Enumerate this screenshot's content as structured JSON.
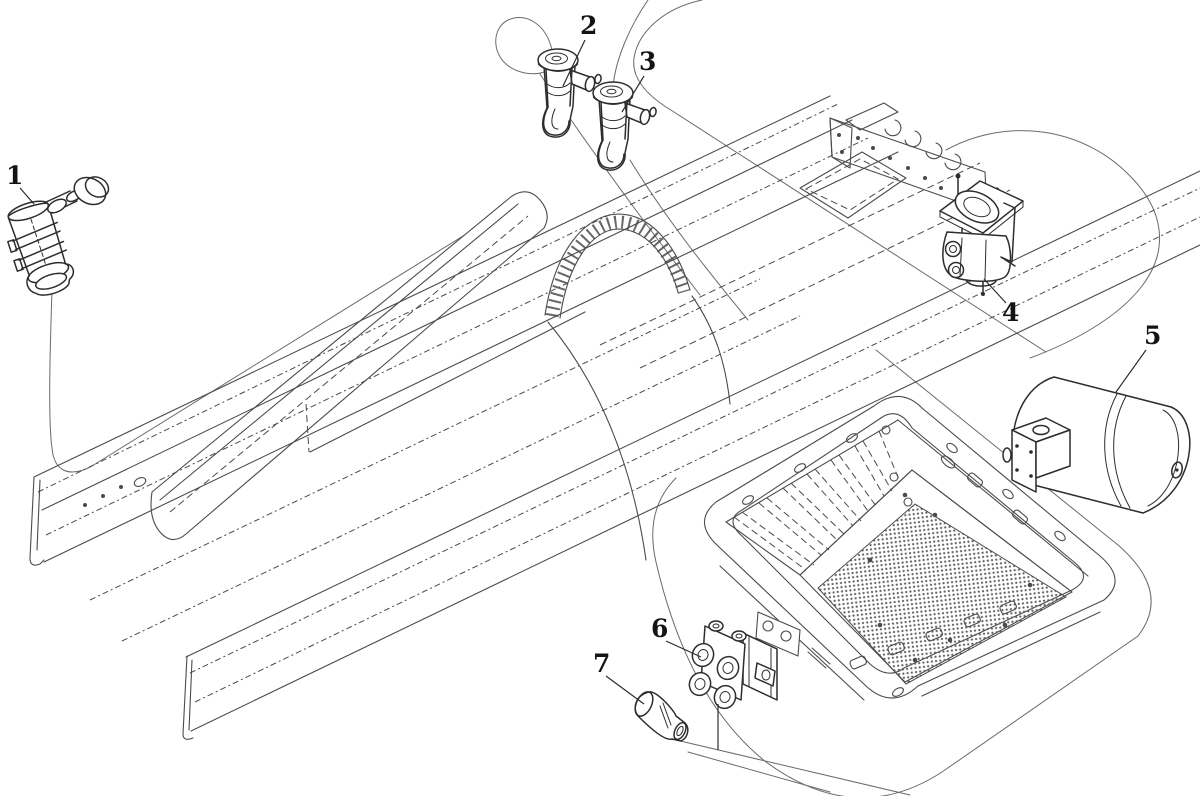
{
  "figure": {
    "type": "exploded-parts-diagram",
    "subject": "truck-chassis-air-system",
    "background": "#ffffff",
    "line_color": "#2d2d2d",
    "frame_line_color": "#4b4b4b",
    "phantom_line_color": "#6b6b6b",
    "mesh_color": "#606060",
    "label_color": "#141414"
  },
  "callouts": [
    {
      "label": "1",
      "part": "control-valve-with-knob",
      "label_x": 6,
      "label_y": 184,
      "leader": {
        "x1": 20,
        "y1": 188,
        "x2": 34,
        "y2": 204
      }
    },
    {
      "label": "2",
      "part": "drain-valve-front",
      "label_x": 580,
      "label_y": 34,
      "leader": {
        "x1": 585,
        "y1": 40,
        "x2": 563,
        "y2": 86
      }
    },
    {
      "label": "3",
      "part": "drain-valve-rear",
      "label_x": 639,
      "label_y": 70,
      "leader": {
        "x1": 644,
        "y1": 76,
        "x2": 622,
        "y2": 112
      }
    },
    {
      "label": "4",
      "part": "relay-valve",
      "label_x": 1002,
      "label_y": 321,
      "leader": {
        "x1": 984,
        "y1": 279,
        "x2": 1006,
        "y2": 303
      }
    },
    {
      "label": "5",
      "part": "air-reservoir-tank",
      "label_x": 1144,
      "label_y": 344,
      "leader": {
        "x1": 1146,
        "y1": 350,
        "x2": 1116,
        "y2": 392
      }
    },
    {
      "label": "6",
      "part": "manifold-block",
      "label_x": 651,
      "label_y": 637,
      "leader": {
        "x1": 666,
        "y1": 641,
        "x2": 701,
        "y2": 657
      }
    },
    {
      "label": "7",
      "part": "plug-fitting",
      "label_x": 593,
      "label_y": 672,
      "leader": {
        "x1": 606,
        "y1": 676,
        "x2": 644,
        "y2": 704
      }
    }
  ]
}
